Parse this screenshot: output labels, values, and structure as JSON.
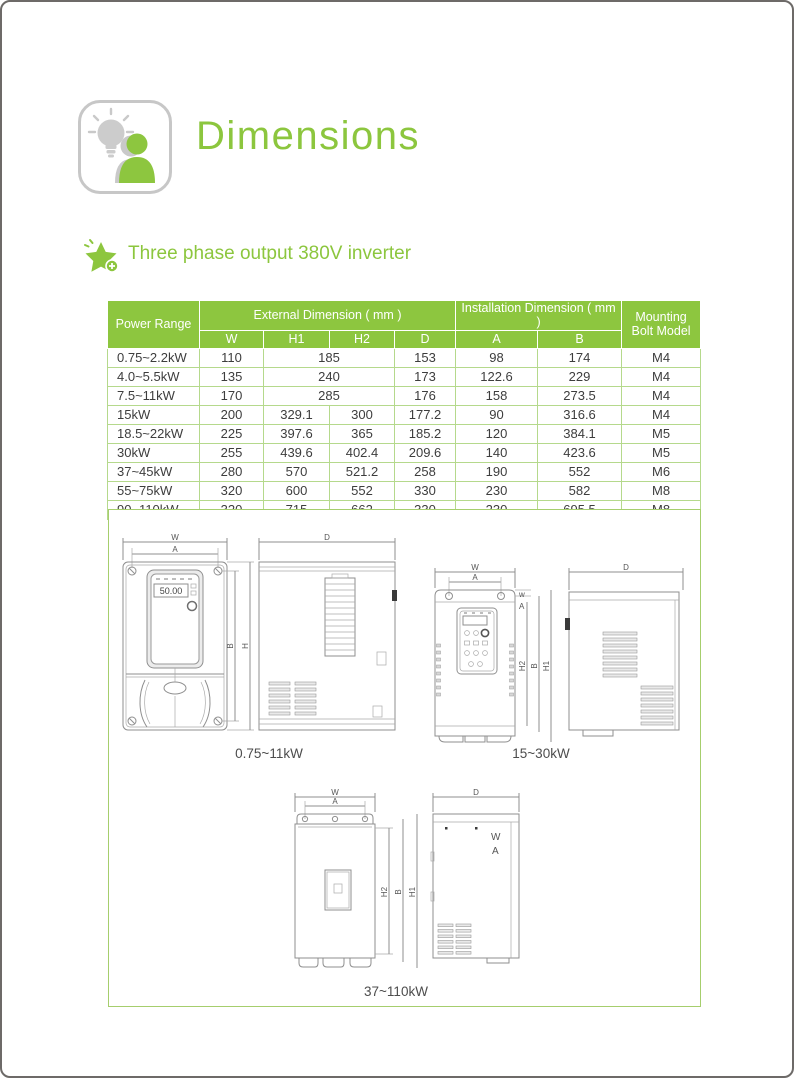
{
  "page": {
    "title": "Dimensions",
    "section_heading": "Three phase output 380V inverter"
  },
  "colors": {
    "accent_green": "#8dc63f",
    "table_line_green": "#b5d98c",
    "box_border_green": "#a6ce6d",
    "drawing_gray": "#8f8f8f",
    "frame_gray": "#6d6a68"
  },
  "table": {
    "header": {
      "power_range": "Power Range",
      "external": "External Dimension ( mm )",
      "installation": "Installation Dimension ( mm )",
      "mounting": "Mounting Bolt Model",
      "sub": {
        "w": "W",
        "h1": "H1",
        "h2": "H2",
        "d": "D",
        "a": "A",
        "b": "B"
      }
    },
    "rows": [
      {
        "power": "0.75~2.2kW",
        "w": "110",
        "h": "185",
        "d": "153",
        "a": "98",
        "b": "174",
        "bolt": "M4"
      },
      {
        "power": "4.0~5.5kW",
        "w": "135",
        "h": "240",
        "d": "173",
        "a": "122.6",
        "b": "229",
        "bolt": "M4"
      },
      {
        "power": "7.5~11kW",
        "w": "170",
        "h": "285",
        "d": "176",
        "a": "158",
        "b": "273.5",
        "bolt": "M4"
      },
      {
        "power": "15kW",
        "w": "200",
        "h1": "329.1",
        "h2": "300",
        "d": "177.2",
        "a": "90",
        "b": "316.6",
        "bolt": "M4"
      },
      {
        "power": "18.5~22kW",
        "w": "225",
        "h1": "397.6",
        "h2": "365",
        "d": "185.2",
        "a": "120",
        "b": "384.1",
        "bolt": "M5"
      },
      {
        "power": "30kW",
        "w": "255",
        "h1": "439.6",
        "h2": "402.4",
        "d": "209.6",
        "a": "140",
        "b": "423.6",
        "bolt": "M5"
      },
      {
        "power": "37~45kW",
        "w": "280",
        "h1": "570",
        "h2": "521.2",
        "d": "258",
        "a": "190",
        "b": "552",
        "bolt": "M6"
      },
      {
        "power": "55~75kW",
        "w": "320",
        "h1": "600",
        "h2": "552",
        "d": "330",
        "a": "230",
        "b": "582",
        "bolt": "M8"
      },
      {
        "power": "90~110kW",
        "w": "320",
        "h1": "715",
        "h2": "662",
        "d": "330",
        "a": "230",
        "b": "695.5",
        "bolt": "M8"
      }
    ]
  },
  "drawings": {
    "group1": {
      "label": "0.75~11kW",
      "display_value": "50.00",
      "dim_w": "W",
      "dim_a": "A",
      "dim_b": "B",
      "dim_h": "H",
      "dim_d": "D"
    },
    "group2": {
      "label": "15~30kW",
      "dim_w": "W",
      "dim_a": "A",
      "dim_small_w": "w",
      "dim_small_a": "A",
      "dim_h2": "H2",
      "dim_b": "B",
      "dim_h1": "H1",
      "dim_d": "D"
    },
    "group3": {
      "label": "37~110kW",
      "dim_w": "W",
      "dim_a": "A",
      "dim_h2": "H2",
      "dim_b": "B",
      "dim_h1": "H1",
      "dim_d": "D",
      "side_text_w": "W",
      "side_text_a": "A"
    }
  }
}
